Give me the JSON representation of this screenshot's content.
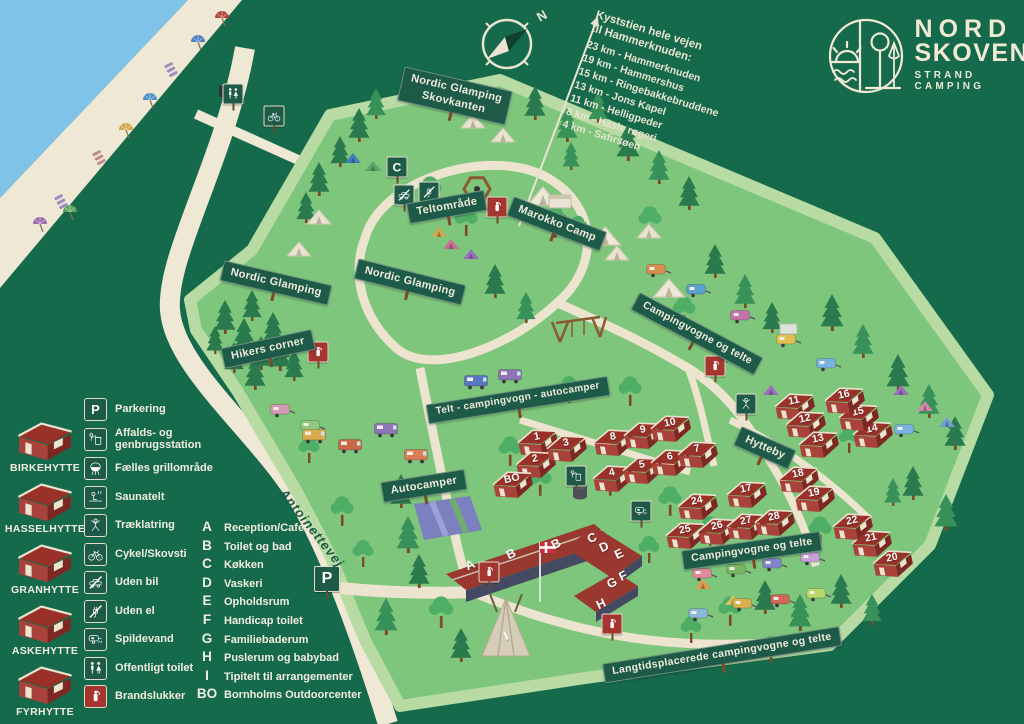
{
  "colors": {
    "background_green": "#156A4B",
    "camp_green": "#7EC67B",
    "verge_green": "#B7DBA3",
    "sea_blue": "#7FC3E8",
    "sand": "#EFE8D4",
    "sign_green": "#1D5A48",
    "cabin_red": "#9B352E",
    "cream": "#EFE9D6",
    "extinguisher_red": "#A5352F"
  },
  "brand": {
    "line1": "NORD",
    "line2": "SKOVEN",
    "tagline": "STRAND CAMPING"
  },
  "compass": {
    "north": "N"
  },
  "trail": {
    "heading1": "Kyststien hele vejen",
    "heading2": "til Hammerknuden:",
    "stops": [
      "23 km - Hammerknuden",
      "19 km - Hammershus",
      "15 km - Ringebakkebruddene",
      "13 km - Jons Kapel",
      "11 km - Helligpeder",
      "8 km - Hasle røgeri",
      "4 km - Safirsøen"
    ]
  },
  "road": {
    "name": "Antoinettevej"
  },
  "legend": {
    "cabin_types": [
      {
        "name": "BIRKEHYTTE"
      },
      {
        "name": "HASSELHYTTE"
      },
      {
        "name": "GRANHYTTE"
      },
      {
        "name": "ASKEHYTTE"
      },
      {
        "name": "FYRHYTTE"
      }
    ],
    "facilities": [
      {
        "text": "P",
        "label": "Parkering"
      },
      {
        "icon": "trash",
        "label": "Affalds- og genbrugsstation"
      },
      {
        "icon": "grill",
        "label": "Fælles grillområde"
      },
      {
        "icon": "sauna",
        "label": "Saunatelt"
      },
      {
        "icon": "climb",
        "label": "Træklatring"
      },
      {
        "icon": "bike",
        "label": "Cykel/Skovsti"
      },
      {
        "icon": "nocar",
        "label": "Uden bil"
      },
      {
        "icon": "noel",
        "label": "Uden el"
      },
      {
        "icon": "drain",
        "label": "Spildevand"
      },
      {
        "icon": "wc",
        "label": "Offentligt toilet"
      },
      {
        "icon": "ext",
        "label": "Brandslukker",
        "red": true
      }
    ],
    "letters": [
      {
        "key": "A",
        "label": "Reception/Cafe"
      },
      {
        "key": "B",
        "label": "Toilet og bad"
      },
      {
        "key": "C",
        "label": "Køkken"
      },
      {
        "key": "D",
        "label": "Vaskeri"
      },
      {
        "key": "E",
        "label": "Opholdsrum"
      },
      {
        "key": "F",
        "label": "Handicap toilet"
      },
      {
        "key": "G",
        "label": "Familiebaderum"
      },
      {
        "key": "H",
        "label": "Puslerum og babybad"
      },
      {
        "key": "I",
        "label": "Tipitelt til arrangementer"
      },
      {
        "key": "BO",
        "label": "Bornholms Outdoorcenter"
      }
    ]
  },
  "area_signs": [
    {
      "label": "Nordic Glamping\nSkovkanten",
      "x": 455,
      "y": 96,
      "rot": 13,
      "fs": 11
    },
    {
      "label": "Teltområde",
      "x": 447,
      "y": 207,
      "rot": -10,
      "fs": 11
    },
    {
      "label": "Marokko Camp",
      "x": 557,
      "y": 224,
      "rot": 21,
      "fs": 11
    },
    {
      "label": "Nordic Glamping",
      "x": 276,
      "y": 283,
      "rot": 13,
      "fs": 11
    },
    {
      "label": "Nordic Glamping",
      "x": 410,
      "y": 282,
      "rot": 14,
      "fs": 11
    },
    {
      "label": "Hikers corner",
      "x": 268,
      "y": 349,
      "rot": -12,
      "fs": 11
    },
    {
      "label": "Telt - campingvogn - autocamper",
      "x": 518,
      "y": 400,
      "rot": -9,
      "fs": 10
    },
    {
      "label": "Campingvogne og telte",
      "x": 697,
      "y": 334,
      "rot": 28,
      "fs": 10.5
    },
    {
      "label": "Autocamper",
      "x": 424,
      "y": 486,
      "rot": -9,
      "fs": 11
    },
    {
      "label": "Hytteby",
      "x": 765,
      "y": 448,
      "rot": 24,
      "fs": 11
    },
    {
      "label": "Campingvogne og telte",
      "x": 752,
      "y": 551,
      "rot": -8,
      "fs": 10.5
    },
    {
      "label": "Langtidsplacerede campingvogne og telte",
      "x": 722,
      "y": 655,
      "rot": -9,
      "fs": 10.5
    }
  ],
  "cabins": [
    {
      "n": "1",
      "x": 538,
      "y": 442
    },
    {
      "n": "2",
      "x": 536,
      "y": 464
    },
    {
      "n": "3",
      "x": 567,
      "y": 448
    },
    {
      "n": "4",
      "x": 613,
      "y": 478
    },
    {
      "n": "5",
      "x": 643,
      "y": 470
    },
    {
      "n": "6",
      "x": 671,
      "y": 462
    },
    {
      "n": "7",
      "x": 698,
      "y": 454
    },
    {
      "n": "8",
      "x": 614,
      "y": 442
    },
    {
      "n": "9",
      "x": 644,
      "y": 435
    },
    {
      "n": "10",
      "x": 671,
      "y": 428
    },
    {
      "n": "11",
      "x": 795,
      "y": 406
    },
    {
      "n": "12",
      "x": 806,
      "y": 424
    },
    {
      "n": "13",
      "x": 819,
      "y": 444
    },
    {
      "n": "14",
      "x": 873,
      "y": 434
    },
    {
      "n": "15",
      "x": 859,
      "y": 417
    },
    {
      "n": "16",
      "x": 845,
      "y": 400
    },
    {
      "n": "17",
      "x": 747,
      "y": 494
    },
    {
      "n": "18",
      "x": 799,
      "y": 479
    },
    {
      "n": "19",
      "x": 815,
      "y": 498
    },
    {
      "n": "20",
      "x": 893,
      "y": 563
    },
    {
      "n": "21",
      "x": 872,
      "y": 543
    },
    {
      "n": "22",
      "x": 853,
      "y": 526
    },
    {
      "n": "24",
      "x": 698,
      "y": 506
    },
    {
      "n": "25",
      "x": 686,
      "y": 535
    },
    {
      "n": "26",
      "x": 718,
      "y": 531
    },
    {
      "n": "27",
      "x": 747,
      "y": 526
    },
    {
      "n": "28",
      "x": 775,
      "y": 522
    },
    {
      "n": "BO",
      "x": 513,
      "y": 484
    }
  ],
  "building_letters": [
    {
      "ch": "A",
      "x": 470,
      "y": 565
    },
    {
      "ch": "B",
      "x": 511,
      "y": 554
    },
    {
      "ch": "B",
      "x": 556,
      "y": 544
    },
    {
      "ch": "C",
      "x": 592,
      "y": 538
    },
    {
      "ch": "D",
      "x": 604,
      "y": 547
    },
    {
      "ch": "E",
      "x": 619,
      "y": 554
    },
    {
      "ch": "F",
      "x": 623,
      "y": 576
    },
    {
      "ch": "G",
      "x": 612,
      "y": 583
    },
    {
      "ch": "H",
      "x": 601,
      "y": 604
    },
    {
      "ch": "I",
      "x": 506,
      "y": 636
    }
  ],
  "map_icons": [
    {
      "text": "C",
      "x": 397,
      "y": 167
    },
    {
      "icon": "nocar",
      "x": 404,
      "y": 195
    },
    {
      "icon": "noel",
      "x": 429,
      "y": 192
    },
    {
      "icon": "ext",
      "x": 497,
      "y": 207,
      "red": true
    },
    {
      "icon": "ext",
      "x": 318,
      "y": 352,
      "red": true
    },
    {
      "icon": "ext",
      "x": 715,
      "y": 366,
      "red": true
    },
    {
      "icon": "ext",
      "x": 489,
      "y": 572,
      "red": true
    },
    {
      "icon": "ext",
      "x": 612,
      "y": 624,
      "red": true
    },
    {
      "icon": "climb",
      "x": 746,
      "y": 404
    },
    {
      "icon": "drain",
      "x": 641,
      "y": 511
    },
    {
      "icon": "trash",
      "x": 576,
      "y": 476
    },
    {
      "icon": "wc",
      "x": 233,
      "y": 94
    },
    {
      "icon": "bike",
      "x": 274,
      "y": 116
    },
    {
      "text": "P",
      "x": 327,
      "y": 579,
      "big": true
    }
  ]
}
